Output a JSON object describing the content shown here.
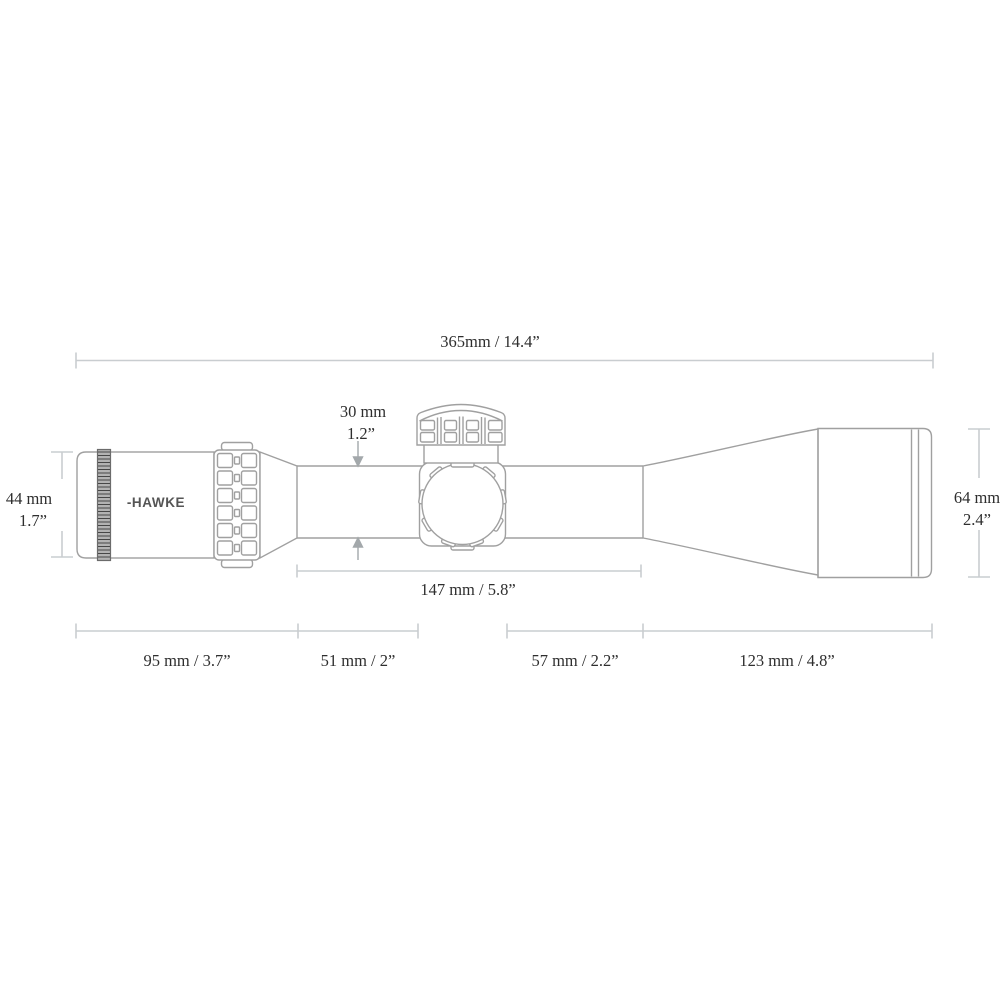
{
  "diagram": {
    "brand": {
      "logo": "-HAWKE"
    },
    "dims": {
      "overall": "365mm / 14.4”",
      "tube_mm": "30 mm",
      "tube_in": "1.2”",
      "ocular_mm": "44 mm",
      "ocular_in": "1.7”",
      "objective_mm": "64 mm",
      "objective_in": "2.4”",
      "saddle_span": "147 mm / 5.8”",
      "seg_eyepiece": "95 mm / 3.7”",
      "seg_tube_front": "51 mm / 2”",
      "seg_tube_rear": "57 mm / 2.2”",
      "seg_objective": "123 mm / 4.8”"
    },
    "colors": {
      "background": "#ffffff",
      "line_art": "#a0a0a0",
      "dimension_lines": "#c9cdd0",
      "arrow": "#a3a8ab",
      "label_text": "#2e2e2e",
      "knurl_dark": "#474747"
    }
  }
}
